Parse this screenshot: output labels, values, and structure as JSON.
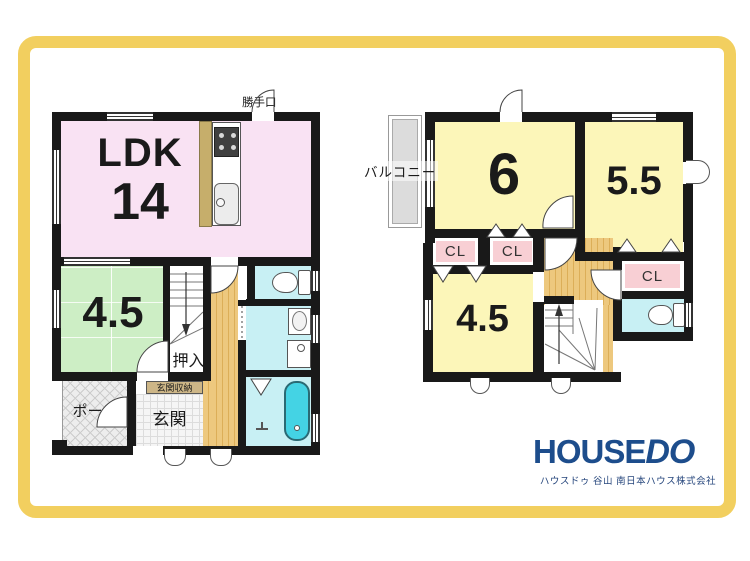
{
  "colors": {
    "frame_yellow": "#f2cf5f",
    "wall_black": "#191919",
    "ldk_pink": "#f9e2f3",
    "tatami_green": "#cdeec5",
    "room_yellow": "#fcf6b9",
    "closet_pink": "#f8cfd4",
    "water_cyan": "#c8f0f4",
    "tub_cyan": "#44d3e4",
    "hall_tan": "#edc87e",
    "counter_tan": "#c6ae6b",
    "storage_tan": "#cdb687",
    "balcony_gray": "#dcdcdc",
    "logo_blue": "#1d4d8c"
  },
  "floor1": {
    "back_door_label": "勝手口",
    "ldk_label": "LDK",
    "ldk_size": "14",
    "tatami_room_size": "4.5",
    "closet_label": "押入",
    "entrance_storage_label": "玄関収納",
    "entrance_label": "玄関",
    "porch_label": "ポーチ"
  },
  "floor2": {
    "balcony_label": "バルコニー",
    "room6_size": "6",
    "room55_size": "5.5",
    "room45_size": "4.5",
    "closet1_label": "CL",
    "closet2_label": "CL",
    "closet3_label": "CL"
  },
  "branding": {
    "logo_house": "HOUSE",
    "logo_do": "DO",
    "company_line": "ハウスドゥ 谷山 南日本ハウス株式会社"
  }
}
